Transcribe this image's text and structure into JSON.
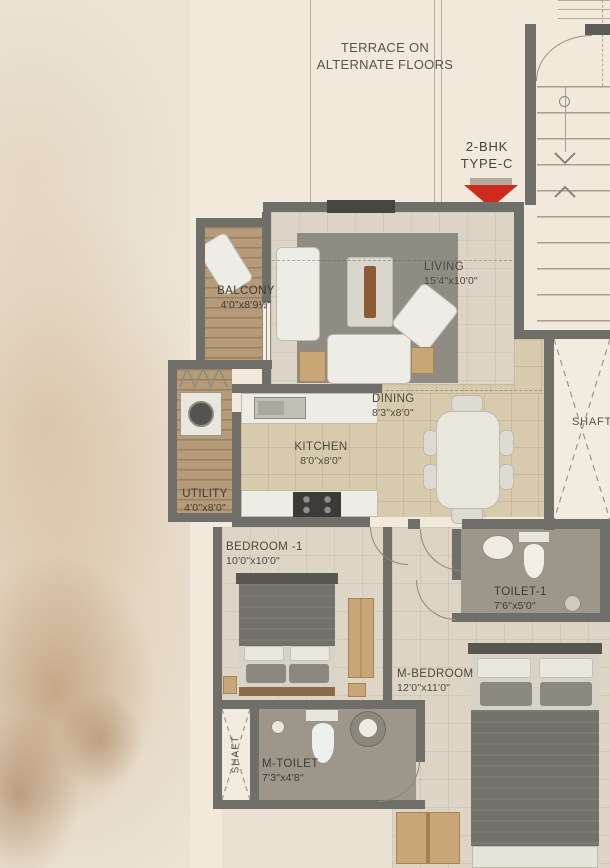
{
  "title": "2-BHK Type-C Floor Plan",
  "terrace_note": "TERRACE ON ALTERNATE FLOORS",
  "unit": {
    "line1": "2-BHK",
    "line2": "TYPE-C"
  },
  "rooms": {
    "balcony": {
      "name": "BALCONY",
      "dims": "4'0\"x8'9½\""
    },
    "living": {
      "name": "LIVING",
      "dims": "15'4\"x10'0\""
    },
    "dining": {
      "name": "DINING",
      "dims": "8'3\"x8'0\""
    },
    "kitchen": {
      "name": "KITCHEN",
      "dims": "8'0\"x8'0\""
    },
    "utility": {
      "name": "UTILITY",
      "dims": "4'0\"x8'0\""
    },
    "bedroom1": {
      "name": "BEDROOM -1",
      "dims": "10'0\"x10'0\""
    },
    "toilet1": {
      "name": "TOILET-1",
      "dims": "7'6\"x5'0\""
    },
    "m_bedroom": {
      "name": "M-BEDROOM",
      "dims": "12'0\"x11'0\""
    },
    "m_toilet": {
      "name": "M-TOILET",
      "dims": "7'3\"x4'8\""
    }
  },
  "shafts": {
    "left": "SHAFT",
    "right": "SHAFT"
  },
  "colors": {
    "wall": "#6f6e69",
    "arrow_red": "#ce2a1e",
    "wood_floor": "#b59b79",
    "tile_tan": "#d8cbad",
    "toilet_floor": "#9d978b",
    "rug": "#8f8c83",
    "paper": "#f0e9dc",
    "text": "#4a4840"
  }
}
